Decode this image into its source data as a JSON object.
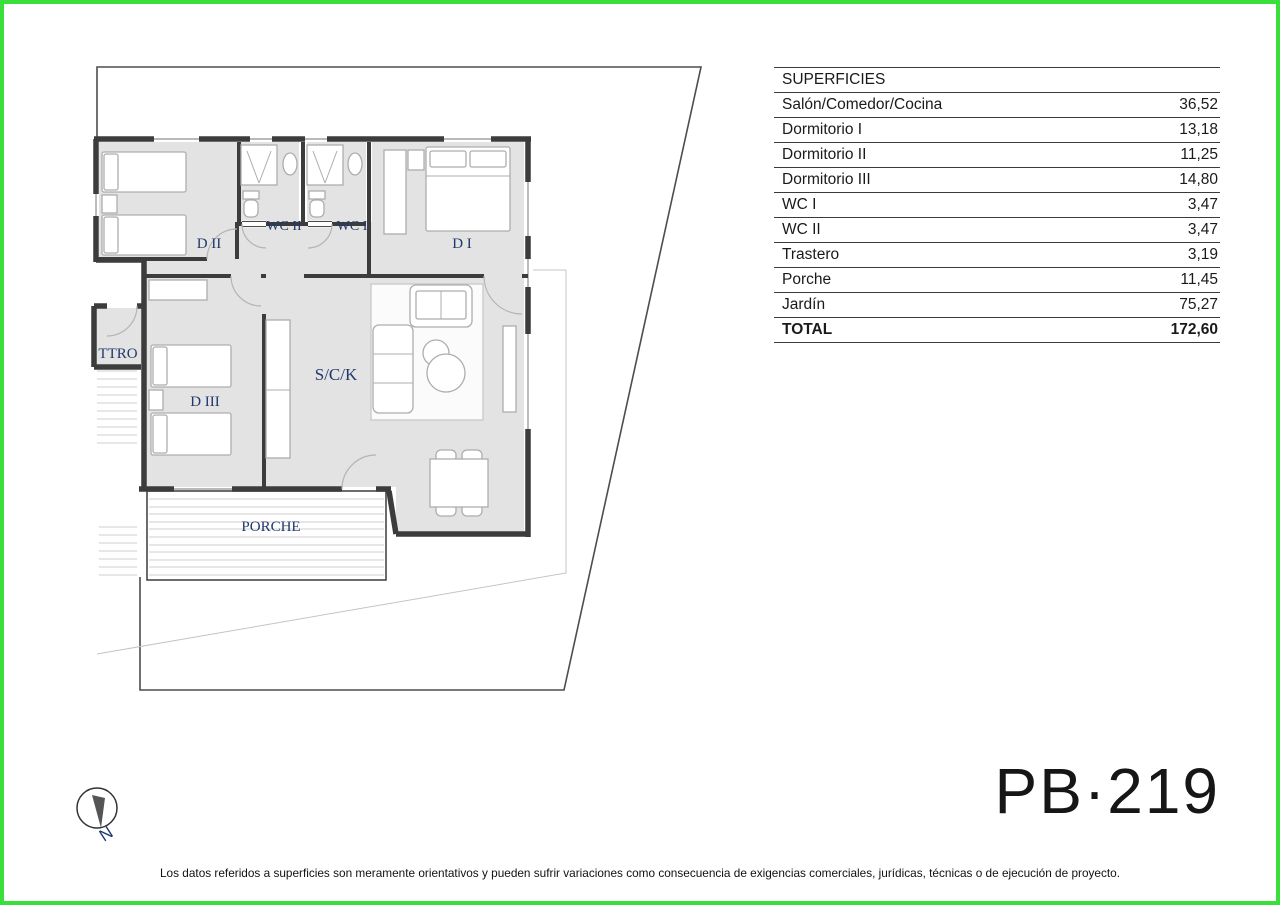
{
  "colors": {
    "accent_border": "#3bdf3b",
    "room_label": "#20386b",
    "wall": "#3c3c3c",
    "floor_fill": "#e3e3e3"
  },
  "table": {
    "header": "SUPERFICIES",
    "rows": [
      {
        "label": "Salón/Comedor/Cocina",
        "value": "36,52"
      },
      {
        "label": "Dormitorio I",
        "value": "13,18"
      },
      {
        "label": "Dormitorio II",
        "value": "11,25"
      },
      {
        "label": "Dormitorio III",
        "value": "14,80"
      },
      {
        "label": "WC I",
        "value": "3,47"
      },
      {
        "label": "WC II",
        "value": "3,47"
      },
      {
        "label": "Trastero",
        "value": "3,19"
      },
      {
        "label": "Porche",
        "value": "11,45"
      },
      {
        "label": "Jardín",
        "value": "75,27"
      }
    ],
    "total": {
      "label": "TOTAL",
      "value": "172,60"
    }
  },
  "plan": {
    "labels": [
      {
        "text": "D II"
      },
      {
        "text": "WC II"
      },
      {
        "text": "WC I"
      },
      {
        "text": "D I"
      },
      {
        "text": "TTRO"
      },
      {
        "text": "D III"
      },
      {
        "text": "S/C/K"
      },
      {
        "text": "PORCHE"
      }
    ],
    "compass_letter": "N"
  },
  "plan_code": "PB·219",
  "disclaimer": "Los datos referidos a superficies son meramente orientativos y pueden sufrir variaciones como consecuencia de exigencias comerciales, jurídicas, técnicas o de ejecución de proyecto."
}
